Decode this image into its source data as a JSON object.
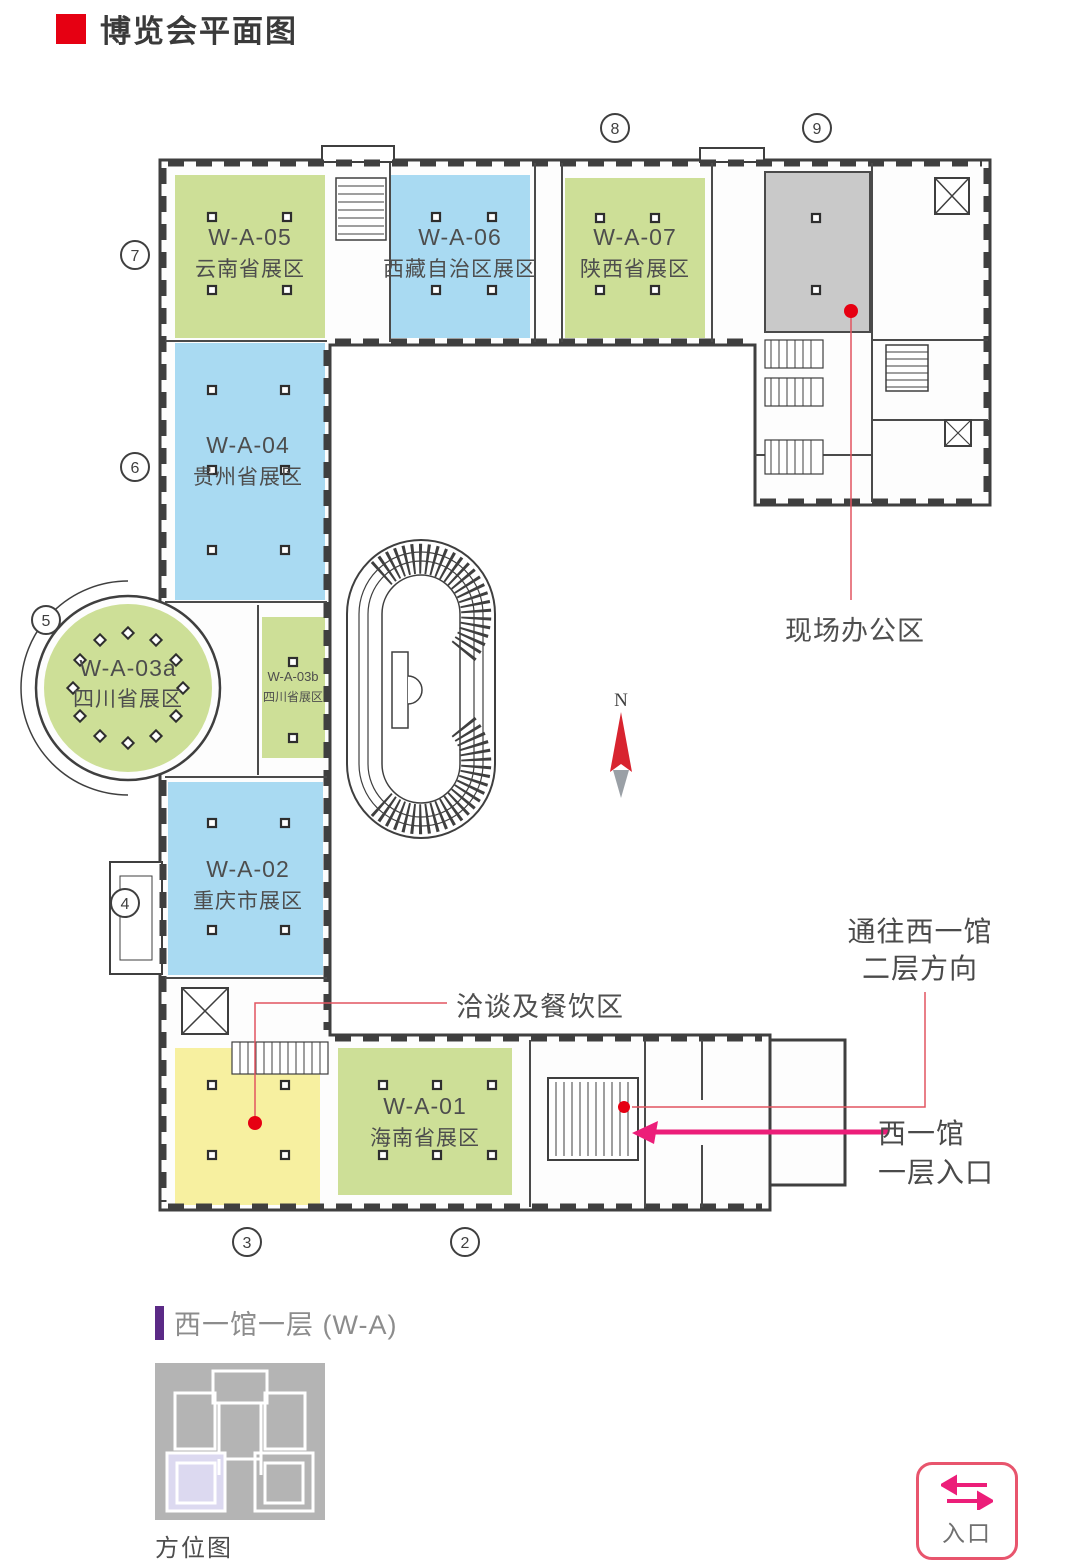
{
  "header": {
    "title": "博览会平面图"
  },
  "colors": {
    "zone_green": "#cddf97",
    "zone_blue": "#a9daf2",
    "zone_yellow": "#f7f0a0",
    "zone_gray": "#c9c9c9",
    "title_red": "#e60012",
    "leader_red": "#e25560",
    "magenta": "#ec1e79",
    "purple_bar": "#5b2a86"
  },
  "plan": {
    "zones": [
      {
        "code": "W-A-05",
        "name": "云南省展区",
        "color": "#cddf97"
      },
      {
        "code": "W-A-06",
        "name": "西藏自治区展区",
        "color": "#a9daf2"
      },
      {
        "code": "W-A-07",
        "name": "陕西省展区",
        "color": "#cddf97"
      },
      {
        "code": "W-A-04",
        "name": "贵州省展区",
        "color": "#a9daf2"
      },
      {
        "code": "W-A-03a",
        "name": "四川省展区",
        "color": "#cddf97"
      },
      {
        "code": "W-A-03b",
        "name": "四川省展区",
        "color": "#cddf97"
      },
      {
        "code": "W-A-02",
        "name": "重庆市展区",
        "color": "#a9daf2"
      },
      {
        "code": "W-A-01",
        "name": "海南省展区",
        "color": "#cddf97"
      }
    ],
    "office_label": "现场办公区",
    "dining_label": "洽谈及餐饮区",
    "upstairs_label_1": "通往西一馆",
    "upstairs_label_2": "二层方向",
    "entrance_label_1": "西一馆",
    "entrance_label_2": "一层入口",
    "compass_n": "N",
    "markers": {
      "m2": "2",
      "m3": "3",
      "m4": "4",
      "m5": "5",
      "m6": "6",
      "m7": "7",
      "m8": "8",
      "m9": "9"
    }
  },
  "footer": {
    "section_title": "西一馆一层 (W-A)",
    "map_caption": "方位图",
    "entrance_button": "入口"
  }
}
